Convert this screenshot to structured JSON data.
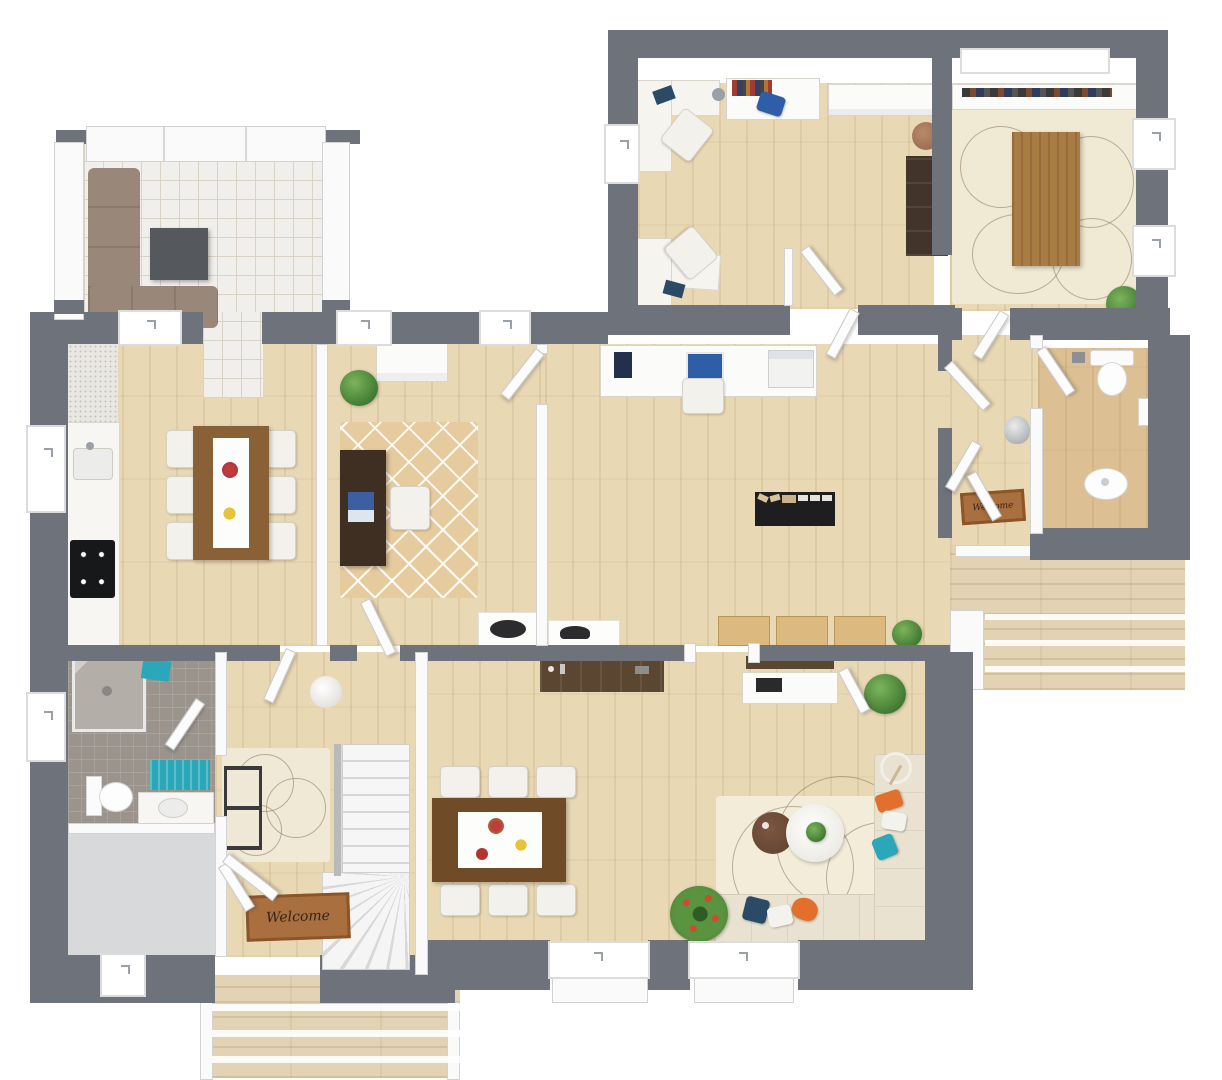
{
  "labels": {
    "welcome_mat": "Welcome"
  },
  "palette": {
    "wall": "#6d727b",
    "wood_floor": "#e9d8b4",
    "tile_floor": "#f0efec",
    "gray_tile": "#9a948d",
    "deck": "#e2d3b4",
    "rug_cream": "#f0e9d3",
    "rug_trellis": "#e6cb9e",
    "sofa_brown": "#99877a",
    "sofa_cream": "#e9e2d1",
    "chair_brown": "#b18b76",
    "table_wood": "#a87c42",
    "table_dark": "#6f4b28",
    "desk_dark": "#3f2f23",
    "accent_teal": "#2aa7b8",
    "accent_orange": "#e2702c",
    "accent_navy": "#2b4a66",
    "plant_green": "#3f7a31",
    "mat_brown": "#a96f3f"
  },
  "floorplan": {
    "type": "3d-floor-plan-top-view",
    "rooms": [
      {
        "name": "sunroom-lounge",
        "floor": "white-tile",
        "furniture": [
          "brown corner sofa",
          "dark square coffee table"
        ]
      },
      {
        "name": "home-office",
        "floor": "light-wood",
        "furniture": [
          "two white corner desks with laptops",
          "two white chairs",
          "console with books",
          "white sideboard",
          "dark bookcase",
          "round stool"
        ]
      },
      {
        "name": "conference-dining-room",
        "floor": "cream rug over wood",
        "furniture": [
          "long wood table",
          "eight brown chairs",
          "white credenza with books",
          "potted plant"
        ]
      },
      {
        "name": "kitchen-dining",
        "floor": "light-wood",
        "furniture": [
          "counter with sink and black cooktop",
          "wood dining table with white runner",
          "six white chairs",
          "flowers and plates"
        ]
      },
      {
        "name": "study",
        "floor": "light-wood",
        "furniture": [
          "trellis rug",
          "dark desk with laptop",
          "white chair",
          "white dresser",
          "plant"
        ]
      },
      {
        "name": "hallway",
        "floor": "light-wood",
        "furniture": [
          "white computer desk with monitor and printer",
          "shoe rack with shoes",
          "three wood benches",
          "console with bowl",
          "plant"
        ]
      },
      {
        "name": "wc",
        "floor": "light-wood",
        "furniture": [
          "toilet",
          "pedestal sink"
        ]
      },
      {
        "name": "side-entry",
        "floor": "light-wood",
        "furniture": [
          "welcome mat",
          "vase",
          "open double doors"
        ]
      },
      {
        "name": "bathroom",
        "floor": "gray-tile",
        "furniture": [
          "corner shower",
          "toilet",
          "vanity with sink",
          "teal bath mat",
          "teal towels"
        ]
      },
      {
        "name": "storage-room",
        "floor": "gray"
      },
      {
        "name": "entry-hall",
        "floor": "light-wood",
        "furniture": [
          "area rug",
          "black bench with cushions",
          "white pouf",
          "winding staircase",
          "welcome mat"
        ]
      },
      {
        "name": "living-dining-room",
        "floor": "light-wood",
        "furniture": [
          "dark sideboard",
          "tv console",
          "wood dining table with runner",
          "six white chairs",
          "cream corner sofa",
          "two round coffee tables",
          "floor lamp",
          "wreath plant",
          "corner plant",
          "accent pillows"
        ]
      },
      {
        "name": "right-deck",
        "floor": "deck-planks-with-steps"
      },
      {
        "name": "front-porch",
        "floor": "deck-planks-with-steps"
      }
    ]
  }
}
